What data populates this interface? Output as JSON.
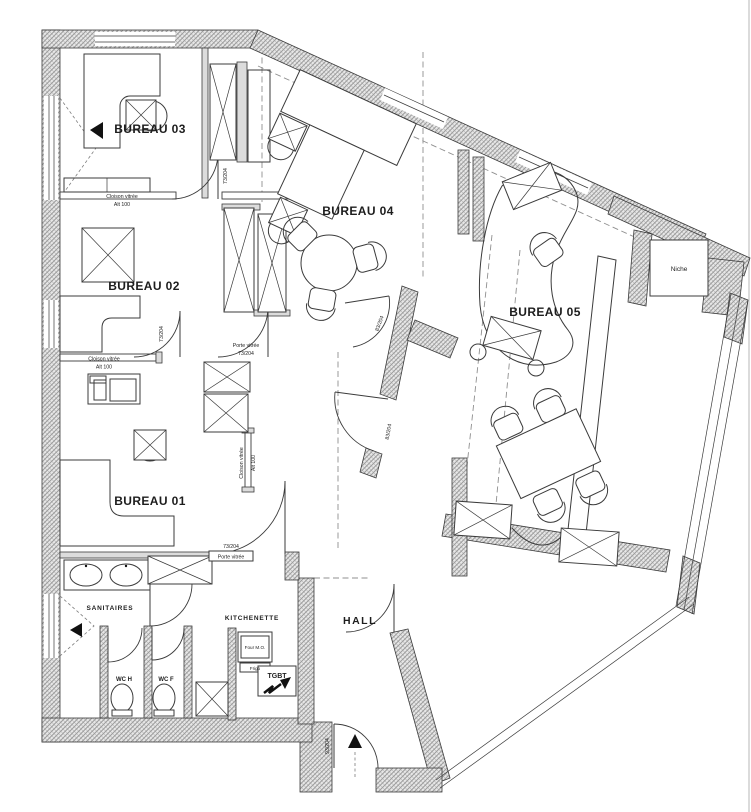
{
  "rooms": {
    "bureau01": "BUREAU 01",
    "bureau02": "BUREAU 02",
    "bureau03": "BUREAU 03",
    "bureau04": "BUREAU 04",
    "bureau05": "BUREAU 05",
    "sanitaires": "SANITAIRES",
    "kitchenette": "KITCHENETTE",
    "hall": "HALL",
    "wc_h": "WC H",
    "wc_f": "WC F",
    "niche": "Niche"
  },
  "annotations": {
    "cloison_vitree": "Cloison vitrée",
    "alt_100": "Alt 100",
    "porte_vitree": "Porte vitrée",
    "door_73": "73/204",
    "door_83": "83/204",
    "door_93": "93/204",
    "four_mo": "Four M.O.",
    "frigo": "Frigo",
    "tgbt": "TGBT"
  },
  "colors": {
    "background": "#ffffff",
    "line": "#3b3b3b",
    "wall_fill": "#e7e7e7",
    "wall_hatch": "#9c9c9c",
    "dash": "#8f8f8f",
    "text": "#1d1d1d"
  }
}
